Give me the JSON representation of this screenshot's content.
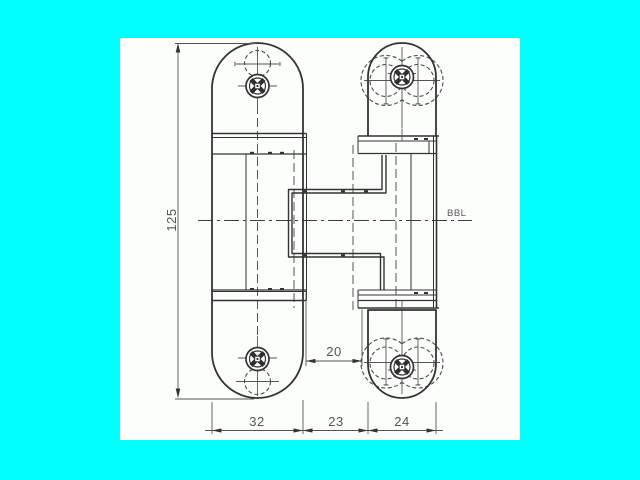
{
  "drawing": {
    "dimensions": {
      "height": "125",
      "offset": "20",
      "leaf_width": "32",
      "gap": "23",
      "frame_leaf_width": "24"
    },
    "reference_label": "BBL"
  },
  "colors": {
    "page_background": "#00ffff",
    "canvas_background": "#fcfefc",
    "line": "#333333",
    "line_soft": "#555555",
    "dimension_text": "#545454"
  }
}
